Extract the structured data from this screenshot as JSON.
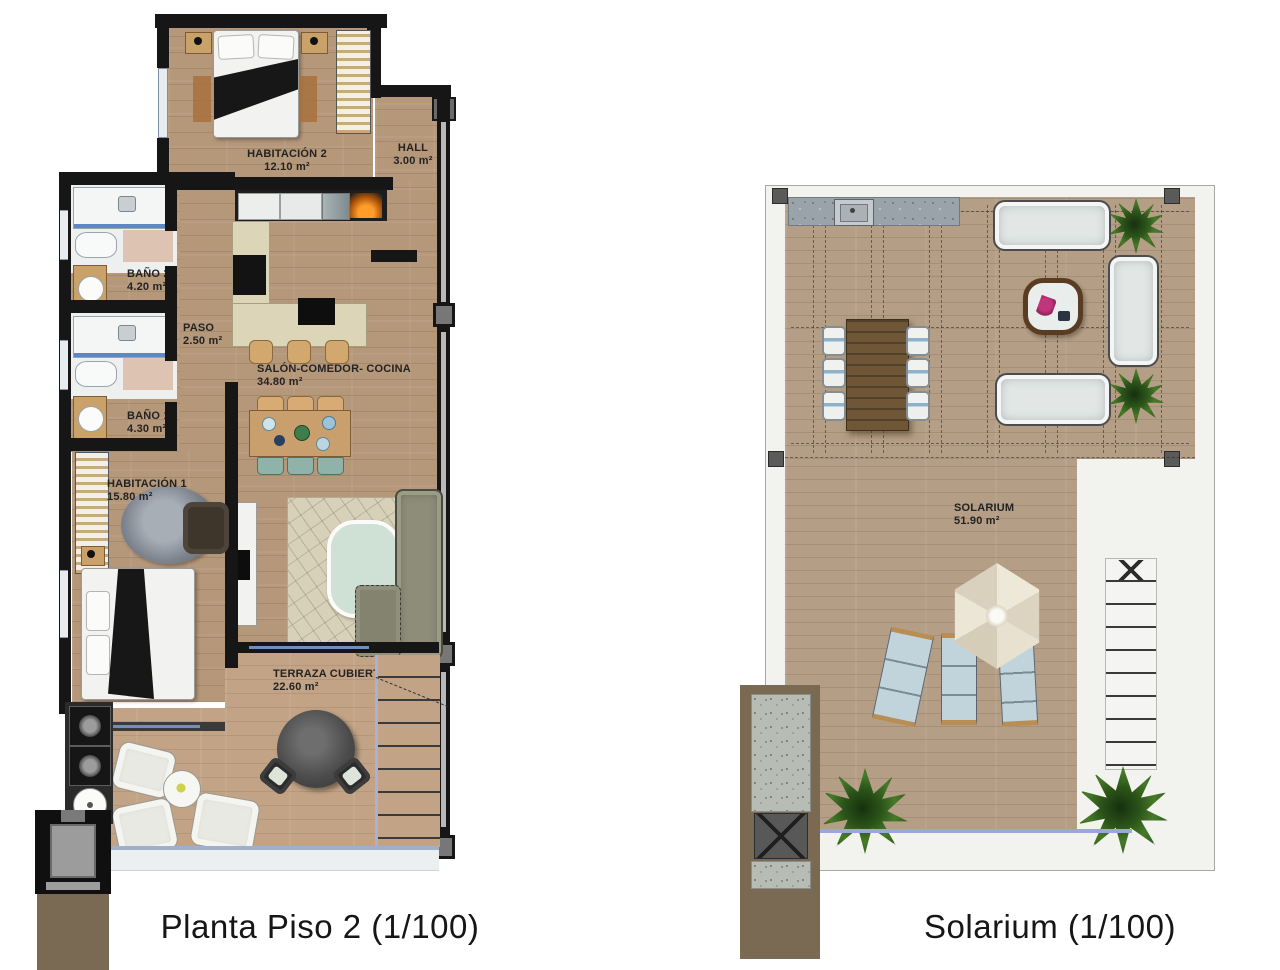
{
  "plans": {
    "piso2": {
      "caption": "Planta Piso 2 (1/100)",
      "rooms": {
        "habitacion2": {
          "name": "HABITACIÓN 2",
          "area": "12.10 m²"
        },
        "hall": {
          "name": "HALL",
          "area": "3.00 m²"
        },
        "bano2": {
          "name": "BAÑO 2",
          "area": "4.20 m²"
        },
        "paso": {
          "name": "PASO",
          "area": "2.50 m²"
        },
        "salon": {
          "name": "SALÓN-COMEDOR- COCINA",
          "area": "34.80 m²"
        },
        "bano1": {
          "name": "BAÑO 1",
          "area": "4.30 m²"
        },
        "habitacion1": {
          "name": "HABITACIÓN 1",
          "area": "15.80 m²"
        },
        "terraza": {
          "name": "TERRAZA CUBIERTA",
          "area": "22.60 m²"
        }
      }
    },
    "solarium": {
      "caption": "Solarium (1/100)",
      "rooms": {
        "solarium": {
          "name": "SOLARIUM",
          "area": "51.90 m²"
        }
      }
    }
  },
  "colors": {
    "wall": "#161616",
    "wood": "#b5977a",
    "terrace_wood": "#c2a385",
    "plant_green": "#3c6823",
    "counter_grey": "#99a3a9",
    "caption_text": "#161616"
  }
}
